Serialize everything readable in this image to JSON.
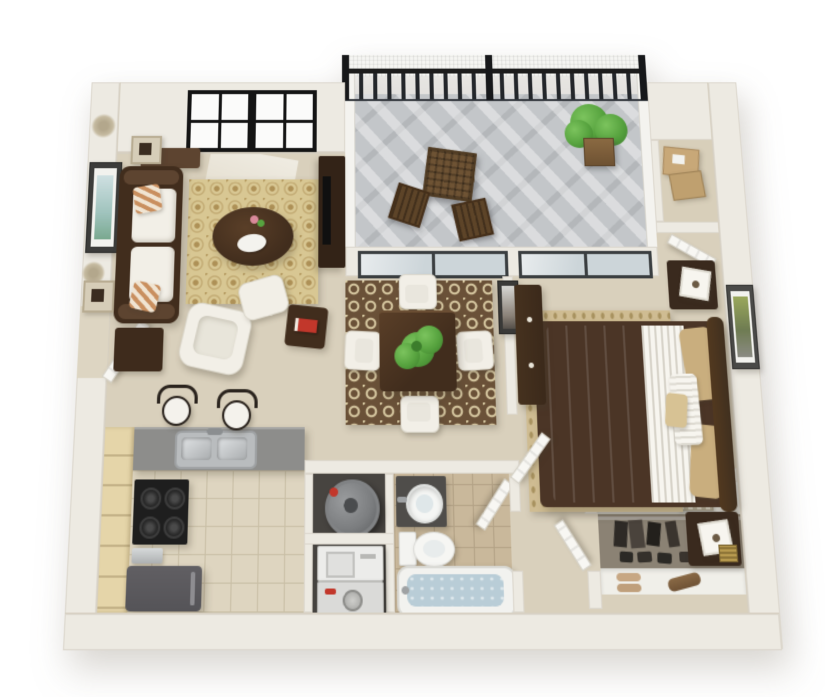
{
  "scene": {
    "type": "3d-floor-plan",
    "subject": "one-bedroom, one-bathroom apartment with balcony",
    "view": "top-down 3d architectural render",
    "background": "#ffffff",
    "visible_text": []
  },
  "palette": {
    "wall": "#edeae2",
    "wall-edge": "#d6cfc0",
    "carpet": "#d9d0bc",
    "tile-kitchen": "#ded5c0",
    "grout-kitchen": "#c9bfa6",
    "tile-bath": "#c9b89b",
    "grout-bath": "#b3a286",
    "deck": "#c3c6c9",
    "railing": "#1f1f1f",
    "glass": "#ccd5d9",
    "wood-dark": "#412d1d",
    "wood-mid": "#5d4430",
    "cushion": "#f2efe7",
    "rug-living": "#d8c793",
    "rug-living-pat": "#ae9157",
    "rug-dining": "#6a5138",
    "rug-dining-pat": "#e8dbb2",
    "rug-bed": "#cfbc92",
    "rug-bed-dot": "#a8925f",
    "comforter": "#cdb284",
    "linen": "#f7f5ef",
    "counter": "#8d8d8b",
    "cabinet": "#e5d5a9",
    "appl-black": "#1e1e1e",
    "appl-gray": "#555458",
    "stainless": "#c7cacc",
    "water": "#b9cdd7",
    "plant": "#57a33f",
    "plant-dark": "#3c7d2c",
    "red": "#c2372b",
    "closet-floor": "#8b8274",
    "floor-dark": "#474440",
    "heater": "#7c7e80",
    "door": "#f8f7f3",
    "box-tan": "#c8a878",
    "pillow-stripe": "#c98f5f",
    "art-blue": "#cfe0e2",
    "art-green": "#9aa85c",
    "shadow": "rgba(70,60,45,.28)"
  },
  "rooms": [
    {
      "id": "living-room",
      "label": "Living Room",
      "floor": "beige carpet",
      "items": [
        "dark wood sofa with white cushions",
        "two striped throw pillows",
        "console table behind sofa",
        "two beige cube wall shelves",
        "two wall medallions",
        "framed wall art with blue-green image",
        "tan damask area rug",
        "oval dark wood coffee table",
        "white decorative tray with flowers",
        "white armchair",
        "white ottoman",
        "dark side table with red book",
        "dark end table",
        "entertainment cabinet with tv",
        "two black-framed double windows",
        "white entry door (open)"
      ]
    },
    {
      "id": "balcony",
      "label": "Balcony",
      "floor": "gray deck boards",
      "items": [
        "black metal railing with vertical bars",
        "white privacy screen",
        "three black railing posts",
        "brown lattice bistro table",
        "two brown slat patio chairs",
        "green potted plant",
        "sliding glass door to dining area",
        "sliding glass door to bedroom"
      ]
    },
    {
      "id": "dining-area",
      "label": "Dining Area",
      "floor": "beige carpet",
      "items": [
        "brown and cream damask rug",
        "square dark wood dining table",
        "green plant centerpiece",
        "four white dining chairs",
        "small framed wall art"
      ]
    },
    {
      "id": "kitchen",
      "label": "Kitchen",
      "floor": "beige tile",
      "items": [
        "light wood cabinet run along wall",
        "gray L-shaped breakfast-bar counter",
        "double stainless sink with faucet",
        "two bar stools with white seats and dark scroll backs",
        "black range with four burners",
        "small countertop appliance",
        "dark gray refrigerator"
      ]
    },
    {
      "id": "utility-closets",
      "label": "Utility Closets",
      "floor": "dark subfloor",
      "items": [
        "round gray water heater with red valve",
        "white washer with lid",
        "gray dryer with round dial and red button"
      ]
    },
    {
      "id": "bathroom",
      "label": "Bathroom",
      "floor": "tan tile",
      "items": [
        "dark vanity with round white vessel sink",
        "white toilet with tank",
        "bathtub filled with water",
        "white door (open)"
      ]
    },
    {
      "id": "bedroom",
      "label": "Bedroom",
      "floor": "beige carpet",
      "items": [
        "bed with tan comforter, striped white linens, tan and white pillows and dark curved headboard",
        "two dark wood nightstands",
        "two white square table lamps",
        "gold striped trinket box",
        "tall dark dresser",
        "textured tan area rug",
        "framed wall art with green image",
        "white bedroom door (open)"
      ]
    },
    {
      "id": "storage-closet",
      "label": "Storage Closet",
      "floor": "beige carpet",
      "items": [
        "two stacked cardboard boxes with white labels",
        "white door (open)"
      ]
    },
    {
      "id": "walk-in-closet",
      "label": "Walk-in Closet",
      "floor": "brown carpet",
      "items": [
        "white upper shelf with brown duffel bag and striped basket",
        "hanging rod with dark clothes",
        "row of dark shoes",
        "white lower shoe shelf with tan sandals and brown shoes",
        "white door (open)"
      ]
    }
  ]
}
